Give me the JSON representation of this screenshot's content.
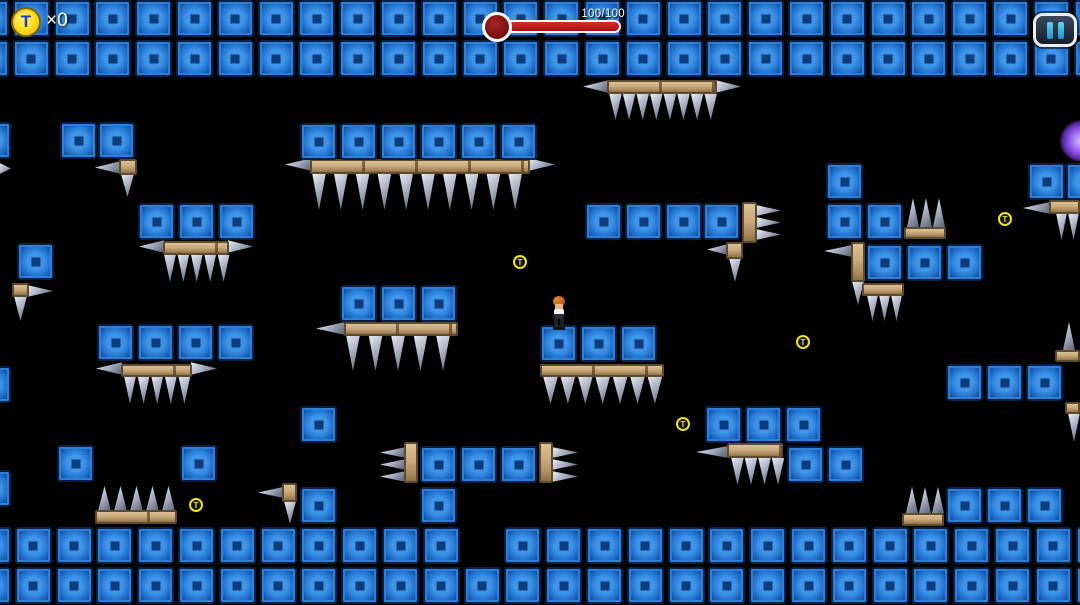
{
  "hud": {
    "coin_symbol": "T",
    "coin_count": "×0",
    "health_text": "100/100",
    "health_current": 100,
    "health_max": 100,
    "pause_icon": "pause-bars-icon"
  },
  "colors": {
    "background": "#010101",
    "block_blue": "#2e7fd8",
    "block_inner": "#0d3c7c",
    "wood_tan": "#c9aa7c",
    "spike_gray": "#aab1c4",
    "coin_yellow": "#f5e31c",
    "coin_letter_blue": "#2038c8",
    "health_red": "#a81212",
    "pause_cyan": "#35b6e8",
    "orb_purple": "#9a63f0"
  },
  "level": {
    "block_size": 37,
    "block_rows": [
      {
        "y": 0,
        "x0": -28,
        "count": 28,
        "pitch": 40.8,
        "skip": []
      },
      {
        "y": 40,
        "x0": -28,
        "count": 28,
        "pitch": 40.8,
        "skip": []
      },
      {
        "y": 527,
        "x0": -26,
        "count": 28,
        "pitch": 40.8,
        "skip": [
          12
        ]
      },
      {
        "y": 567,
        "x0": -26,
        "count": 28,
        "pitch": 40.8,
        "skip": []
      }
    ],
    "blocks": [
      [
        -26,
        122
      ],
      [
        60,
        122
      ],
      [
        98,
        122
      ],
      [
        300,
        123
      ],
      [
        340,
        123
      ],
      [
        380,
        123
      ],
      [
        420,
        123
      ],
      [
        460,
        123
      ],
      [
        500,
        123
      ],
      [
        138,
        203
      ],
      [
        178,
        203
      ],
      [
        218,
        203
      ],
      [
        585,
        203
      ],
      [
        625,
        203
      ],
      [
        665,
        203
      ],
      [
        703,
        203
      ],
      [
        826,
        163
      ],
      [
        826,
        203
      ],
      [
        866,
        203
      ],
      [
        866,
        244
      ],
      [
        906,
        244
      ],
      [
        946,
        244
      ],
      [
        1028,
        163
      ],
      [
        1066,
        163
      ],
      [
        17,
        243
      ],
      [
        97,
        324
      ],
      [
        137,
        324
      ],
      [
        177,
        324
      ],
      [
        217,
        324
      ],
      [
        340,
        285
      ],
      [
        380,
        285
      ],
      [
        420,
        285
      ],
      [
        540,
        325
      ],
      [
        580,
        325
      ],
      [
        620,
        325
      ],
      [
        946,
        364
      ],
      [
        986,
        364
      ],
      [
        1026,
        364
      ],
      [
        705,
        406
      ],
      [
        745,
        406
      ],
      [
        785,
        406
      ],
      [
        787,
        446
      ],
      [
        827,
        446
      ],
      [
        300,
        406
      ],
      [
        300,
        487
      ],
      [
        -26,
        366
      ],
      [
        -26,
        470
      ],
      [
        420,
        446
      ],
      [
        460,
        446
      ],
      [
        500,
        446
      ],
      [
        420,
        487
      ],
      [
        57,
        445
      ],
      [
        180,
        445
      ],
      [
        946,
        487
      ],
      [
        986,
        487
      ],
      [
        1026,
        487
      ]
    ],
    "wood_platforms": [
      [
        607,
        80,
        110,
        14
      ],
      [
        310,
        159,
        220,
        15
      ],
      [
        119,
        159,
        18,
        16
      ],
      [
        163,
        241,
        66,
        14
      ],
      [
        12,
        283,
        17,
        14
      ],
      [
        344,
        322,
        114,
        14
      ],
      [
        540,
        364,
        124,
        13
      ],
      [
        121,
        364,
        71,
        13
      ],
      [
        404,
        442,
        14,
        41
      ],
      [
        539,
        442,
        14,
        41
      ],
      [
        742,
        202,
        15,
        41
      ],
      [
        726,
        242,
        17,
        17
      ],
      [
        851,
        242,
        14,
        40
      ],
      [
        904,
        227,
        42,
        12
      ],
      [
        862,
        283,
        42,
        13
      ],
      [
        1049,
        200,
        31,
        14
      ],
      [
        1055,
        350,
        25,
        12
      ],
      [
        1065,
        402,
        15,
        12
      ],
      [
        95,
        510,
        82,
        14
      ],
      [
        282,
        483,
        15,
        19
      ],
      [
        727,
        443,
        56,
        15
      ],
      [
        902,
        513,
        42,
        13
      ]
    ],
    "spike_groups": [
      {
        "dir": "down",
        "x": 609,
        "y": 94,
        "w": 13,
        "h": 26,
        "count": 8,
        "pitch": 13.6
      },
      {
        "dir": "left",
        "x": 583,
        "y": 80,
        "w": 25,
        "h": 13,
        "count": 1,
        "pitch": 0
      },
      {
        "dir": "right",
        "x": 716,
        "y": 80,
        "w": 25,
        "h": 13,
        "count": 1,
        "pitch": 0
      },
      {
        "dir": "down",
        "x": 312,
        "y": 174,
        "w": 14,
        "h": 36,
        "count": 10,
        "pitch": 21.8
      },
      {
        "dir": "left",
        "x": 285,
        "y": 158,
        "w": 26,
        "h": 13,
        "count": 1,
        "pitch": 0
      },
      {
        "dir": "right",
        "x": 529,
        "y": 158,
        "w": 26,
        "h": 13,
        "count": 1,
        "pitch": 0
      },
      {
        "dir": "down",
        "x": 121,
        "y": 175,
        "w": 13,
        "h": 22,
        "count": 1,
        "pitch": 0
      },
      {
        "dir": "left",
        "x": 95,
        "y": 161,
        "w": 25,
        "h": 13,
        "count": 1,
        "pitch": 0
      },
      {
        "dir": "right",
        "x": 0,
        "y": 163,
        "w": 11,
        "h": 11,
        "count": 1,
        "pitch": 0
      },
      {
        "dir": "down",
        "x": 164,
        "y": 255,
        "w": 12,
        "h": 27,
        "count": 5,
        "pitch": 13.4
      },
      {
        "dir": "left",
        "x": 139,
        "y": 240,
        "w": 25,
        "h": 13,
        "count": 1,
        "pitch": 0
      },
      {
        "dir": "right",
        "x": 228,
        "y": 240,
        "w": 25,
        "h": 13,
        "count": 1,
        "pitch": 0
      },
      {
        "dir": "right",
        "x": 28,
        "y": 285,
        "w": 25,
        "h": 12,
        "count": 1,
        "pitch": 0
      },
      {
        "dir": "down",
        "x": 14,
        "y": 297,
        "w": 13,
        "h": 24,
        "count": 1,
        "pitch": 0
      },
      {
        "dir": "down",
        "x": 346,
        "y": 336,
        "w": 14,
        "h": 35,
        "count": 5,
        "pitch": 22.5
      },
      {
        "dir": "left",
        "x": 316,
        "y": 322,
        "w": 28,
        "h": 13,
        "count": 1,
        "pitch": 0
      },
      {
        "dir": "down",
        "x": 543,
        "y": 377,
        "w": 15,
        "h": 27,
        "count": 7,
        "pitch": 17.4
      },
      {
        "dir": "down",
        "x": 124,
        "y": 377,
        "w": 12,
        "h": 27,
        "count": 5,
        "pitch": 13.6
      },
      {
        "dir": "left",
        "x": 96,
        "y": 362,
        "w": 26,
        "h": 13,
        "count": 1,
        "pitch": 0
      },
      {
        "dir": "right",
        "x": 191,
        "y": 362,
        "w": 26,
        "h": 13,
        "count": 1,
        "pitch": 0
      },
      {
        "dir": "left",
        "x": 380,
        "y": 447,
        "w": 25,
        "h": 11,
        "count": 3,
        "pitch": 12
      },
      {
        "dir": "right",
        "x": 553,
        "y": 447,
        "w": 25,
        "h": 11,
        "count": 3,
        "pitch": 12
      },
      {
        "dir": "right",
        "x": 757,
        "y": 205,
        "w": 24,
        "h": 11,
        "count": 3,
        "pitch": 12
      },
      {
        "dir": "left",
        "x": 707,
        "y": 244,
        "w": 20,
        "h": 11,
        "count": 1,
        "pitch": 0
      },
      {
        "dir": "down",
        "x": 729,
        "y": 259,
        "w": 12,
        "h": 23,
        "count": 1,
        "pitch": 0
      },
      {
        "dir": "left",
        "x": 824,
        "y": 245,
        "w": 27,
        "h": 12,
        "count": 1,
        "pitch": 0
      },
      {
        "dir": "down",
        "x": 852,
        "y": 282,
        "w": 12,
        "h": 23,
        "count": 1,
        "pitch": 0
      },
      {
        "dir": "up",
        "x": 907,
        "y": 198,
        "w": 12,
        "h": 29,
        "count": 3,
        "pitch": 13
      },
      {
        "dir": "down",
        "x": 867,
        "y": 296,
        "w": 11,
        "h": 25,
        "count": 3,
        "pitch": 12
      },
      {
        "dir": "left",
        "x": 1023,
        "y": 202,
        "w": 26,
        "h": 12,
        "count": 1,
        "pitch": 0
      },
      {
        "dir": "down",
        "x": 1056,
        "y": 214,
        "w": 11,
        "h": 26,
        "count": 2,
        "pitch": 12
      },
      {
        "dir": "up",
        "x": 1063,
        "y": 322,
        "w": 12,
        "h": 28,
        "count": 1,
        "pitch": 0
      },
      {
        "dir": "down",
        "x": 1068,
        "y": 414,
        "w": 12,
        "h": 28,
        "count": 1,
        "pitch": 0
      },
      {
        "dir": "up",
        "x": 98,
        "y": 486,
        "w": 13,
        "h": 25,
        "count": 5,
        "pitch": 16
      },
      {
        "dir": "left",
        "x": 258,
        "y": 487,
        "w": 24,
        "h": 11,
        "count": 1,
        "pitch": 0
      },
      {
        "dir": "down",
        "x": 284,
        "y": 502,
        "w": 12,
        "h": 22,
        "count": 1,
        "pitch": 0
      },
      {
        "dir": "left",
        "x": 696,
        "y": 446,
        "w": 31,
        "h": 12,
        "count": 1,
        "pitch": 0
      },
      {
        "dir": "down",
        "x": 731,
        "y": 458,
        "w": 13,
        "h": 27,
        "count": 4,
        "pitch": 13.5
      },
      {
        "dir": "up",
        "x": 906,
        "y": 487,
        "w": 12,
        "h": 26,
        "count": 3,
        "pitch": 13
      }
    ],
    "coins": [
      [
        513,
        255
      ],
      [
        676,
        417
      ],
      [
        796,
        335
      ],
      [
        998,
        212
      ],
      [
        189,
        498
      ]
    ],
    "player": {
      "x": 551,
      "y": 296
    },
    "orb": {
      "x": 1060,
      "y": 120
    }
  }
}
